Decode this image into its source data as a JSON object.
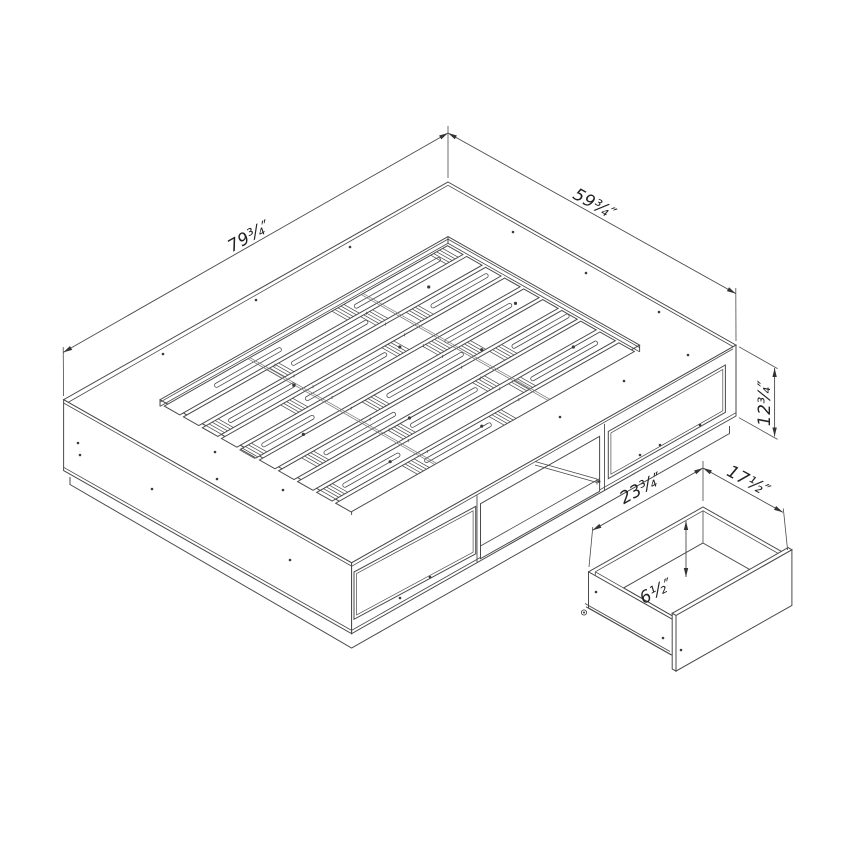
{
  "diagram": {
    "type": "isometric technical drawing",
    "subject": "platform storage bed with slat platform and pull-out storage drawer",
    "background_color": "#ffffff",
    "line_color": "#4a4a4a",
    "text_color": "#222222",
    "dimensions": {
      "bed_length": {
        "label": "79¾″"
      },
      "bed_width": {
        "label": "59¾″"
      },
      "bed_height": {
        "label": "12¾″"
      },
      "drawer_width": {
        "label": "23¾″"
      },
      "drawer_depth": {
        "label": "17½″"
      },
      "drawer_height": {
        "label": "6½″"
      }
    }
  }
}
